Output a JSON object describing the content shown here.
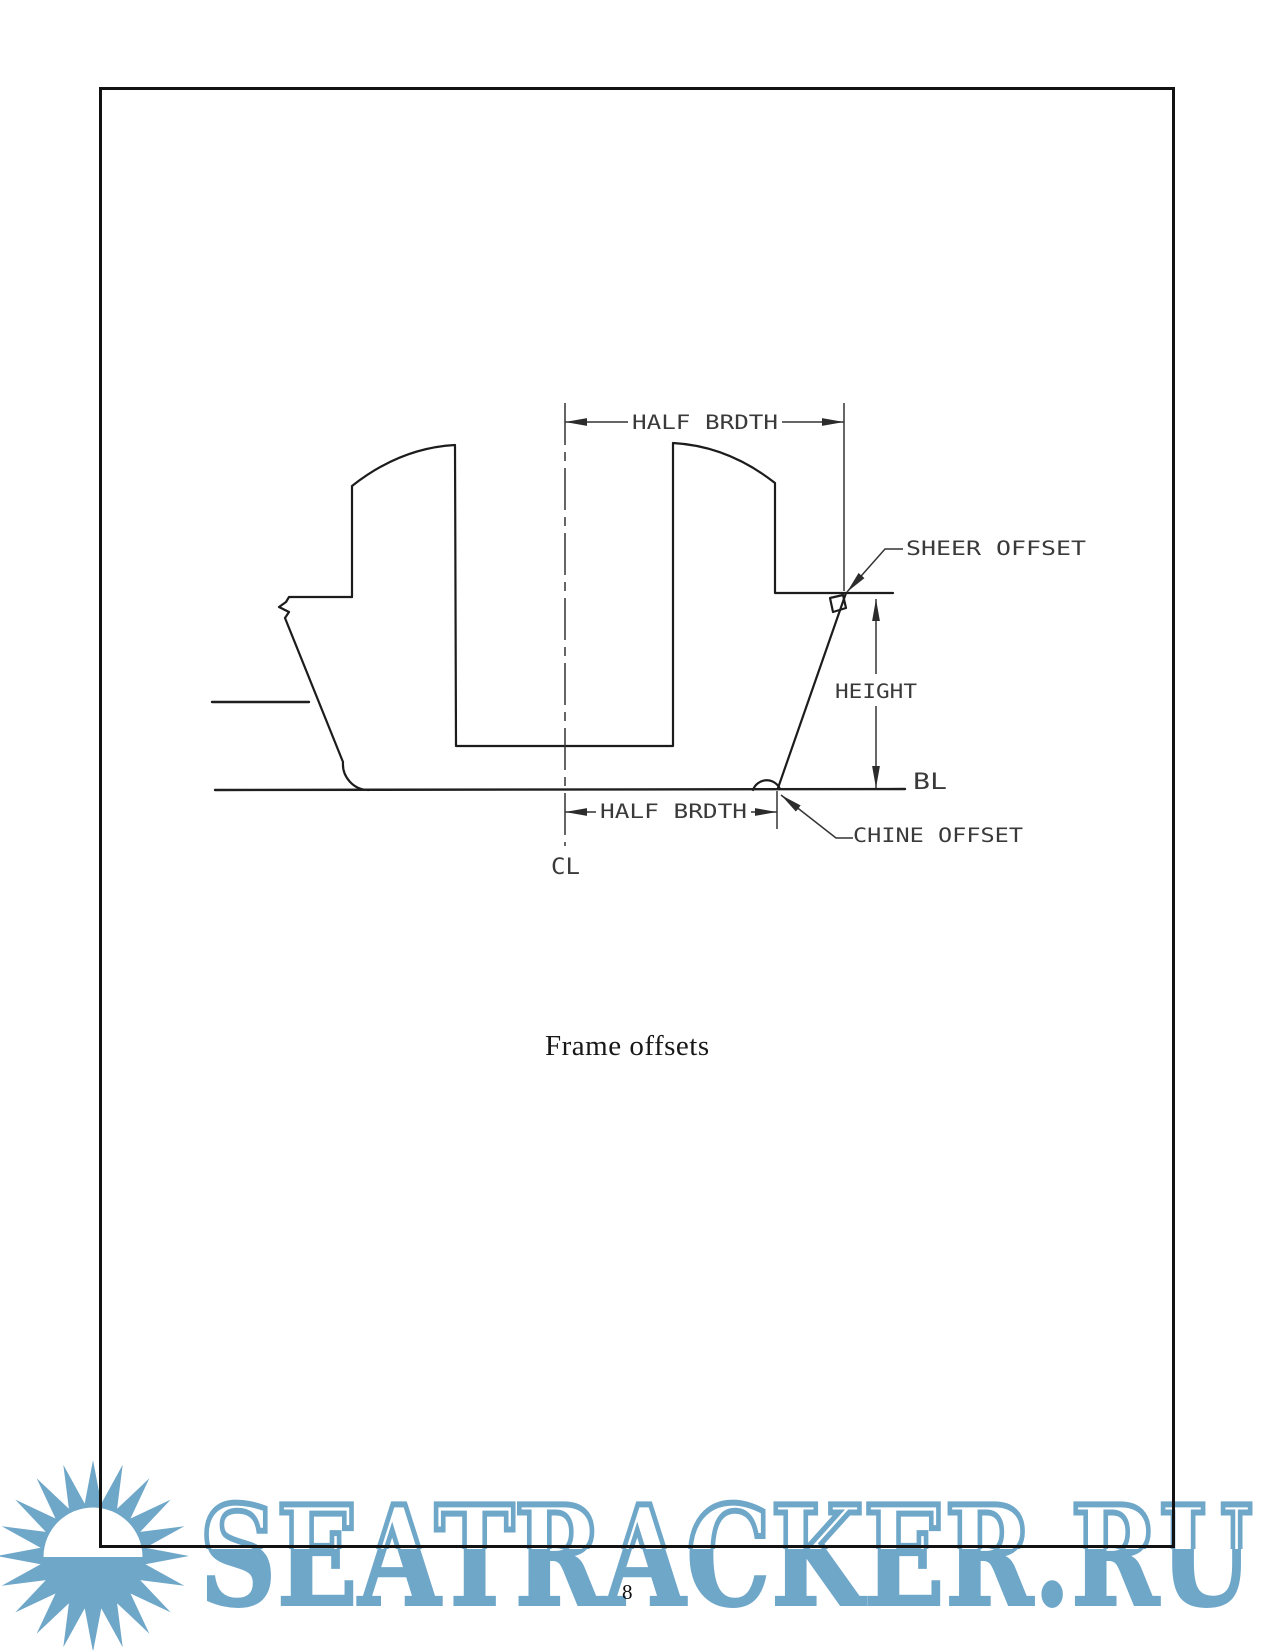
{
  "page": {
    "caption": "Frame offsets",
    "page_number": "8"
  },
  "diagram": {
    "title": "boat frame cross-section with offset dimensions",
    "labels": {
      "half_breadth_top": "HALF BRDTH",
      "sheer_offset": "SHEER OFFSET",
      "height": "HEIGHT",
      "baseline": "BL",
      "half_breadth_bottom": "HALF BRDTH",
      "chine_offset": "CHINE OFFSET",
      "centerline": "CL"
    }
  },
  "watermark": {
    "text": "SEATRACKER.RU",
    "color": "#6fa7c9"
  }
}
